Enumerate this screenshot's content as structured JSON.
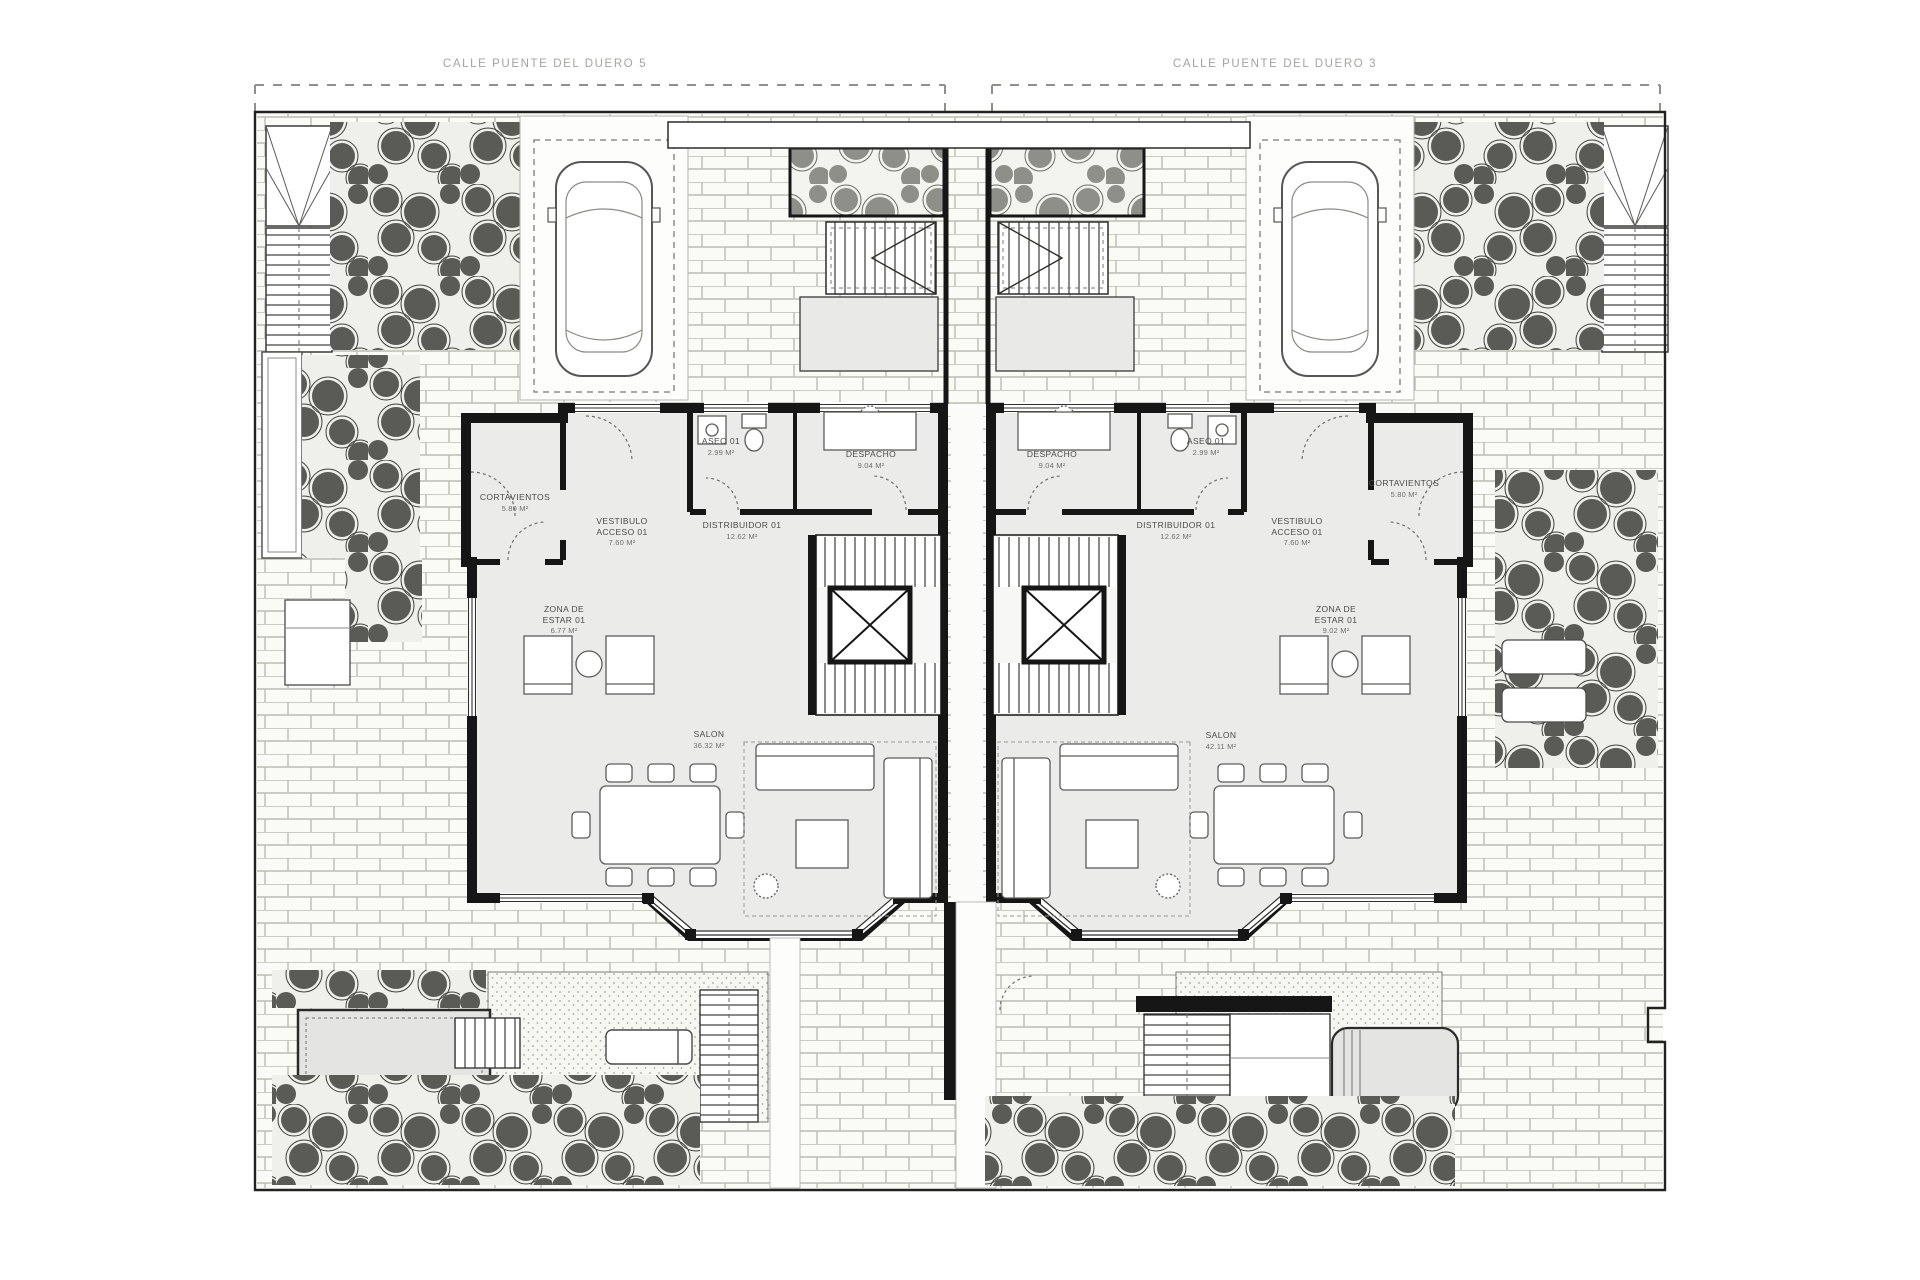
{
  "document": {
    "type": "architectural floor plan",
    "style": "black and white site plan of two mirrored semi-detached houses"
  },
  "streets": {
    "left_label": "CALLE PUENTE DEL DUERO 5",
    "right_label": "CALLE PUENTE DEL DUERO 3"
  },
  "colors": {
    "wall": "#161616",
    "room_fill": "#ebebe9",
    "brick_line": "#bdbdb7",
    "vegetation": "#5a5a57",
    "pool_fill": "#e4e4e2",
    "street_text": "#a3a3a1",
    "label_text": "#4a4a4a"
  },
  "units": {
    "left": {
      "rooms": [
        {
          "label": "CORTAVIENTOS",
          "area": "5.80 m²"
        },
        {
          "label": "VESTIBULO ACCESO 01",
          "area": "7.60 m²"
        },
        {
          "label": "DISTRIBUIDOR 01",
          "area": "12.62 m²"
        },
        {
          "label": "ASEO 01",
          "area": "2.99 m²"
        },
        {
          "label": "DESPACHO",
          "area": "9.04 m²"
        },
        {
          "label": "ZONA DE ESTAR 01",
          "area": "6.77 m²"
        },
        {
          "label": "SALON",
          "area": "36.32 m²"
        }
      ]
    },
    "right": {
      "rooms": [
        {
          "label": "DESPACHO",
          "area": "9.04 m²"
        },
        {
          "label": "ASEO 01",
          "area": "2.99 m²"
        },
        {
          "label": "DISTRIBUIDOR 01",
          "area": "12.62 m²"
        },
        {
          "label": "VESTIBULO ACCESO 01",
          "area": "7.60 m²"
        },
        {
          "label": "CORTAVIENTOS",
          "area": "5.80 m²"
        },
        {
          "label": "ZONA DE ESTAR 01",
          "area": "9.02 m²"
        },
        {
          "label": "SALON",
          "area": "42.11 m²"
        }
      ]
    }
  }
}
